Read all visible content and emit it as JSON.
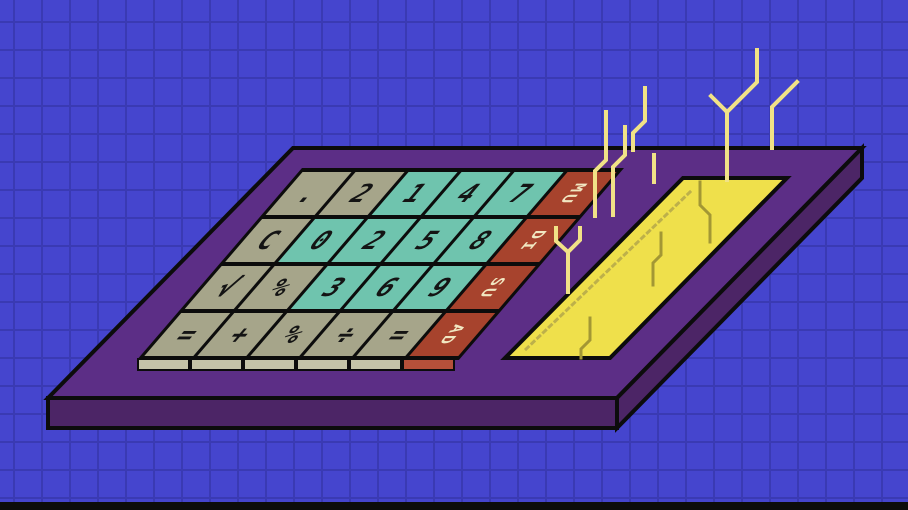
{
  "scene": {
    "title": "Pixel-art illustration of a retro adding-machine calculator on a blue grid background with electric sparks",
    "width": 908,
    "height": 510
  },
  "colors": {
    "background_blue": "#4545CE",
    "grid_line": "#3A3AB3",
    "board_top": "#5C2E86",
    "board_side": "#4C2566",
    "outline_black": "#0C0C0C",
    "key_tan": "#A6A58A",
    "key_teal": "#6FC4AE",
    "key_red": "#A7432D",
    "key_tan_front": "#C4C3A8",
    "key_red_front": "#B5503A",
    "key_glyph": "#141414",
    "red_key_text": "#F1E7C2",
    "display_yellow": "#EFE04B",
    "spark_cream": "#F1E287",
    "trace_olive": "#A39734",
    "shade_dotted": "#BDB04A"
  },
  "keypad": {
    "rows": [
      [
        {
          "label": ".",
          "type": "tan"
        },
        {
          "label": "2",
          "type": "tan"
        },
        {
          "label": "1",
          "type": "teal"
        },
        {
          "label": "4",
          "type": "teal"
        },
        {
          "label": "7",
          "type": "teal"
        },
        {
          "label": "MU",
          "type": "red"
        }
      ],
      [
        {
          "label": "C",
          "type": "tan"
        },
        {
          "label": "0",
          "type": "teal"
        },
        {
          "label": "2",
          "type": "teal"
        },
        {
          "label": "5",
          "type": "teal"
        },
        {
          "label": "8",
          "type": "teal"
        },
        {
          "label": "DI",
          "type": "red"
        }
      ],
      [
        {
          "label": "√",
          "type": "tan"
        },
        {
          "label": "%",
          "type": "tan"
        },
        {
          "label": "3",
          "type": "teal"
        },
        {
          "label": "6",
          "type": "teal"
        },
        {
          "label": "9",
          "type": "teal"
        },
        {
          "label": "SU",
          "type": "red"
        }
      ],
      [
        {
          "label": "=",
          "type": "tan"
        },
        {
          "label": "+",
          "type": "tan"
        },
        {
          "label": "%",
          "type": "tan"
        },
        {
          "label": "÷",
          "type": "tan"
        },
        {
          "label": "=",
          "type": "tan"
        },
        {
          "label": "AD",
          "type": "red"
        }
      ]
    ]
  },
  "key_fronts": [
    "tan",
    "tan",
    "tan",
    "tan",
    "tan",
    "red"
  ],
  "board": {
    "top_face": [
      [
        293,
        148
      ],
      [
        862,
        148
      ],
      [
        617,
        398
      ],
      [
        48,
        398
      ]
    ],
    "front_face": [
      [
        48,
        398
      ],
      [
        617,
        398
      ],
      [
        617,
        428
      ],
      [
        48,
        428
      ]
    ],
    "right_side_face": [
      [
        862,
        148
      ],
      [
        617,
        398
      ],
      [
        617,
        428
      ],
      [
        862,
        178
      ]
    ]
  },
  "display": {
    "panel": [
      [
        683,
        178
      ],
      [
        787,
        178
      ],
      [
        610,
        358
      ],
      [
        505,
        358
      ]
    ],
    "shade_line": [
      [
        690,
        192
      ],
      [
        523,
        352
      ]
    ]
  },
  "sparks": [
    [
      [
        595,
        216
      ],
      [
        595,
        171
      ],
      [
        606,
        160
      ],
      [
        606,
        112
      ]
    ],
    [
      [
        568,
        292
      ],
      [
        568,
        252
      ],
      [
        556,
        241
      ],
      [
        556,
        228
      ]
    ],
    [
      [
        568,
        252
      ],
      [
        580,
        240
      ],
      [
        580,
        228
      ]
    ],
    [
      [
        654,
        182
      ],
      [
        654,
        155
      ]
    ],
    [
      [
        633,
        150
      ],
      [
        633,
        133
      ],
      [
        645,
        121
      ],
      [
        645,
        88
      ]
    ],
    [
      [
        613,
        215
      ],
      [
        613,
        167
      ],
      [
        625,
        155
      ],
      [
        625,
        127
      ]
    ],
    [
      [
        711,
        96
      ],
      [
        727,
        112
      ],
      [
        727,
        180
      ]
    ],
    [
      [
        727,
        112
      ],
      [
        757,
        82
      ],
      [
        757,
        50
      ]
    ],
    [
      [
        797,
        82
      ],
      [
        772,
        107
      ],
      [
        772,
        148
      ]
    ]
  ],
  "traces": [
    [
      [
        700,
        182
      ],
      [
        700,
        205
      ],
      [
        710,
        215
      ],
      [
        710,
        242
      ]
    ],
    [
      [
        661,
        233
      ],
      [
        661,
        255
      ],
      [
        653,
        263
      ],
      [
        653,
        285
      ]
    ],
    [
      [
        590,
        318
      ],
      [
        590,
        340
      ],
      [
        581,
        349
      ],
      [
        581,
        358
      ]
    ]
  ]
}
